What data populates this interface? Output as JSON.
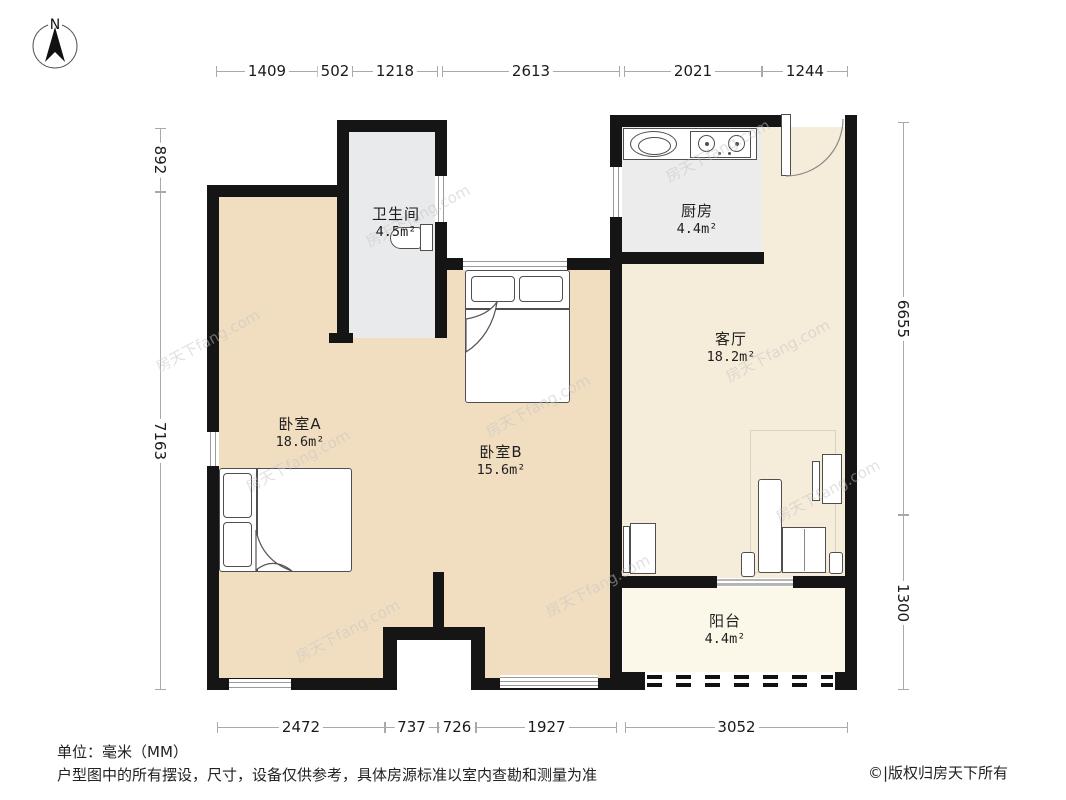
{
  "compass": {
    "label": "N"
  },
  "dims": {
    "unit": "mm",
    "top": [
      "1409",
      "502",
      "1218",
      "2613",
      "2021",
      "1244"
    ],
    "bottom": [
      "2472",
      "737",
      "726",
      "1927",
      "3052"
    ],
    "left": [
      "892",
      "7163"
    ],
    "right": [
      "6655",
      "1300"
    ]
  },
  "rooms": {
    "bathroom": {
      "name": "卫生间",
      "area": "4.5m²"
    },
    "kitchen": {
      "name": "厨房",
      "area": "4.4m²"
    },
    "living": {
      "name": "客厅",
      "area": "18.2m²"
    },
    "bedroomA": {
      "name": "卧室A",
      "area": "18.6m²"
    },
    "bedroomB": {
      "name": "卧室B",
      "area": "15.6m²"
    },
    "balcony": {
      "name": "阳台",
      "area": "4.4m²"
    }
  },
  "footer": {
    "unit_note": "单位：毫米（MM）",
    "disclaimer": "户型图中的所有摆设，尺寸，设备仅供参考，具体房源标准以室内查勘和测量为准",
    "copyright": "©|版权归房天下所有"
  },
  "watermark": {
    "text": "房天下fang.com"
  },
  "colors": {
    "wall": "#151515",
    "bedroom_floor": "#f1dec1",
    "living_floor": "#f6ecda",
    "balcony_floor": "#fbf8e9",
    "kitchen_floor": "#ececec",
    "bathroom_floor": "#e9eaec"
  }
}
